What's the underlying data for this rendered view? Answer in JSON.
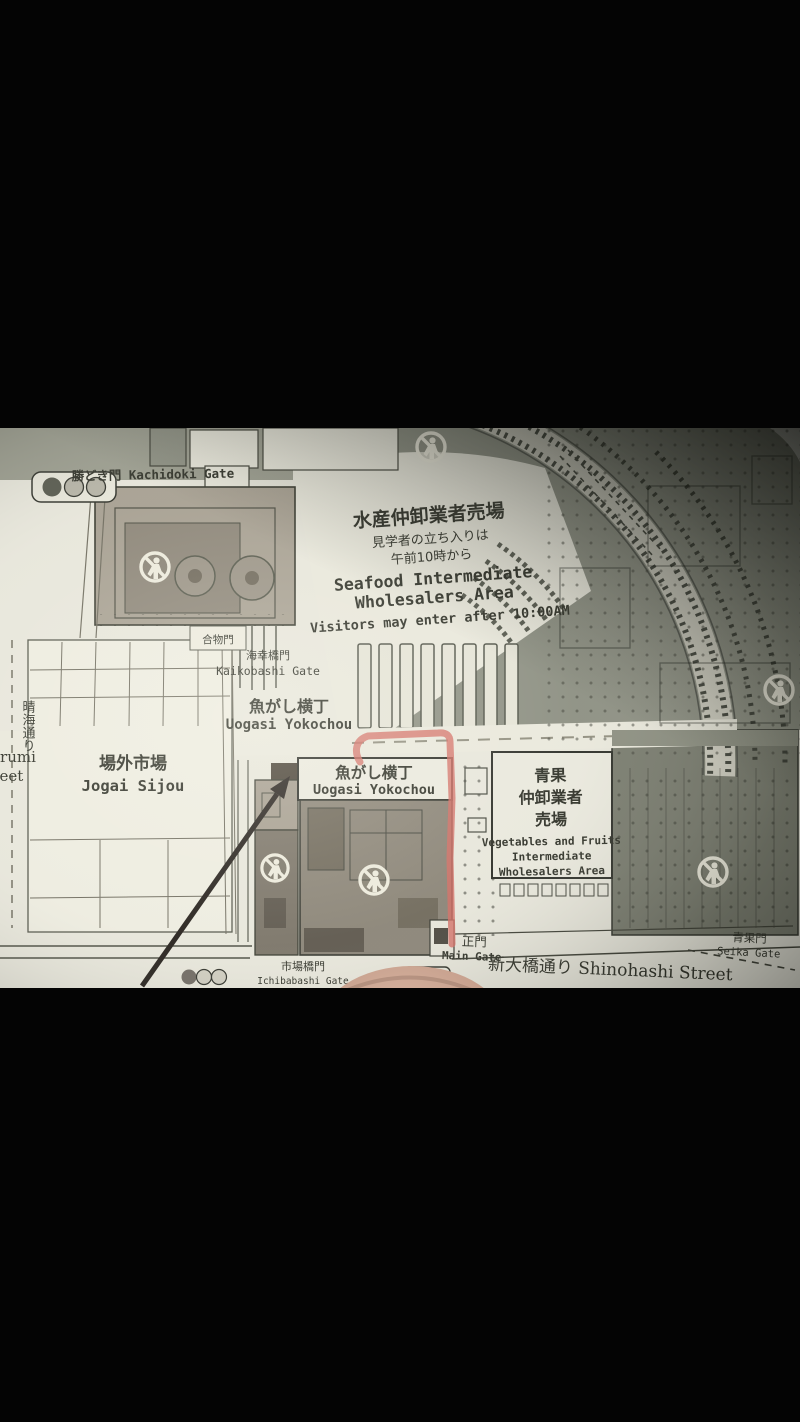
{
  "map": {
    "labels": {
      "kachidoki_gate": "勝どき門 Kachidoki Gate",
      "seafood_area": {
        "jp": "水産仲卸業者売場",
        "note1": "見学者の立ち入りは",
        "note2": "午前10時から",
        "en1": "Seafood Intermediate",
        "en2": "Wholesalers Area",
        "visitors": "Visitors may enter after 10:00AM"
      },
      "awasemono_gate": "合物門",
      "kaikobashi_gate": {
        "jp": "海幸橋門",
        "en": "Kaikobashi Gate"
      },
      "uogasi_yokochou_upper": {
        "jp": "魚がし横丁",
        "en": "Uogasi Yokochou"
      },
      "jogai_sijou": {
        "jp": "場外市場",
        "en": "Jogai Sijou"
      },
      "uogasi_yokochou_building": {
        "jp": "魚がし横丁",
        "en": "Uogasi Yokochou"
      },
      "vegetables_area": {
        "jp1": "青果",
        "jp2": "仲卸業者",
        "jp3": "売場",
        "en1": "Vegetables and Fruits",
        "en2": "Intermediate",
        "en3": "Wholesalers Area"
      },
      "main_gate": {
        "jp": "正門",
        "en": "Main Gate"
      },
      "ichibabashi_gate": {
        "jp": "市場橋門",
        "en": "Ichibabashi Gate"
      },
      "shinohashi_street": "新大橋通り Shinohashi Street",
      "seika_gate": {
        "jp": "青果門",
        "en": "Seika Gate"
      },
      "harumi_street": {
        "jp": "晴海通り",
        "en1": "Harumi",
        "en2": "Street"
      }
    },
    "colors": {
      "paper": "#e7e6da",
      "ink": "#2e3026",
      "gray_zone": "#8b8e80",
      "building": "#a79f90",
      "building_dark": "#8a8375",
      "red_route": "#d96a60",
      "arrow_black": "#241f1a",
      "finger": "#c79c88",
      "letterbox": "#040404"
    },
    "icons": [
      "no-pedestrian-icon",
      "traffic-light-icon"
    ]
  }
}
